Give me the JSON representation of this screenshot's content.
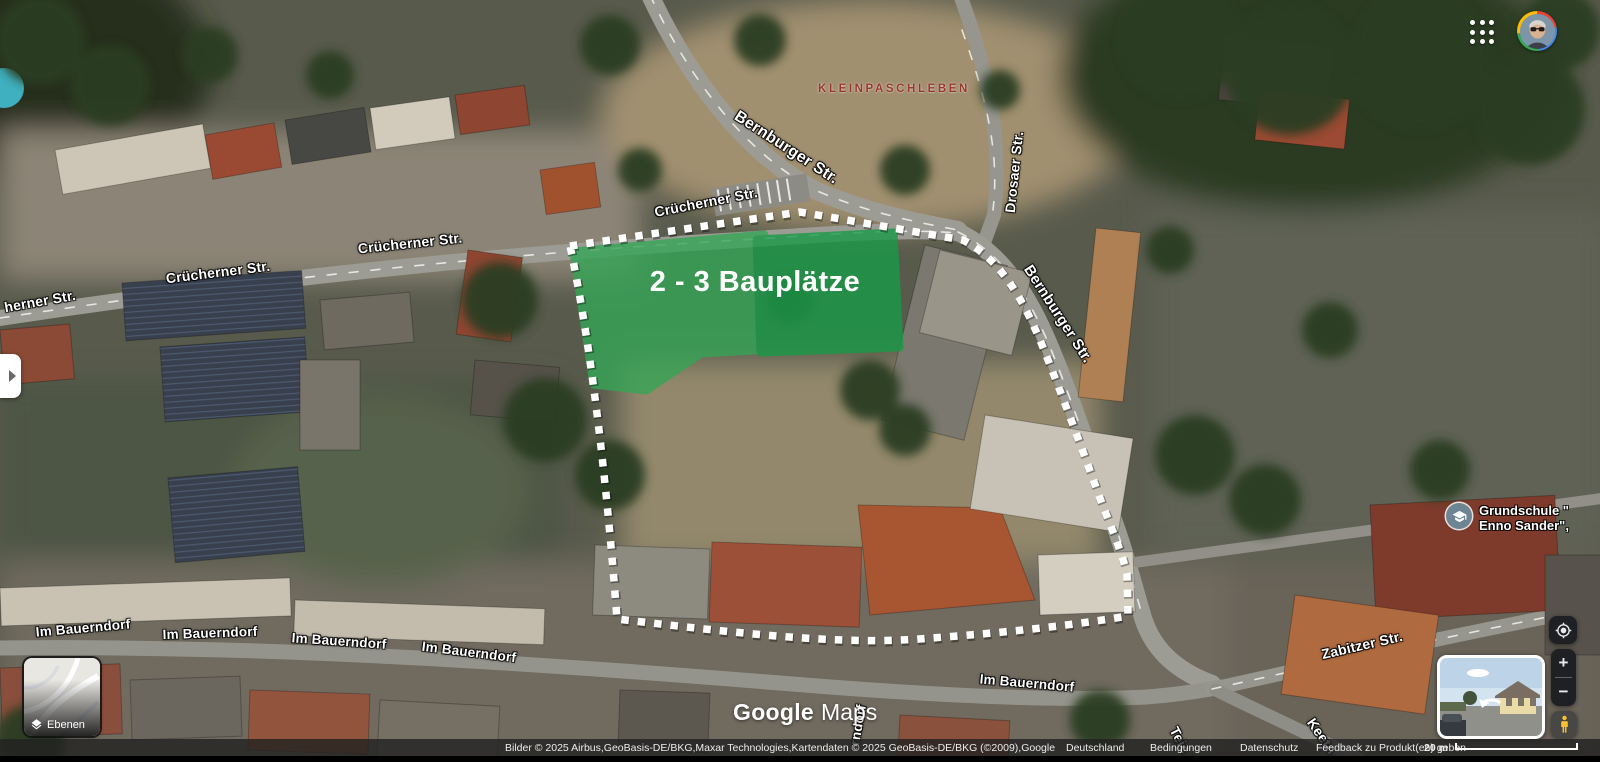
{
  "site": {
    "label": "2 - 3 Bauplätze",
    "highlight_color": "#2aa652"
  },
  "locality_label": "KLEINPASCHLEBEN",
  "school": {
    "line1": "Grundschule \"",
    "line2": "Enno Sander\","
  },
  "streets": {
    "bernburger_top": "Bernburger Str.",
    "bernburger_right": "Bernburger Str.",
    "cruecherner_top": "Crücherner Str.",
    "cruecherner_right": "Crücherner Str.",
    "cruecherner_mid": "Crücherner Str.",
    "cruecherner_left_cut": "herner Str.",
    "drosaer": "Drosaer Str.",
    "bauerndorf_1": "Im Bauerndorf",
    "bauerndorf_2": "Im Bauerndorf",
    "bauerndorf_3": "Im Bauerndorf",
    "bauerndorf_4": "Im Bauerndorf",
    "bauerndorf_5": "Im Bauerndorf",
    "bauerndorf_vert": "rndorf",
    "zabitzer": "Zabitzer Str.",
    "keetner_cut": "Keetn",
    "teich_cut": "Teic"
  },
  "logo": {
    "google": "Google",
    "maps": "Maps"
  },
  "layers_button": {
    "label": "Ebenen"
  },
  "zoom_controls": {
    "zoom_in": "+",
    "zoom_out": "−"
  },
  "attribution": {
    "credits": "Bilder © 2025 Airbus,GeoBasis-DE/BKG,Maxar Technologies,Kartendaten © 2025 GeoBasis-DE/BKG (©2009),Google",
    "links": [
      "Deutschland",
      "Bedingungen",
      "Datenschutz",
      "Feedback zu Produkt(en) geben"
    ],
    "scale": "20 m"
  }
}
